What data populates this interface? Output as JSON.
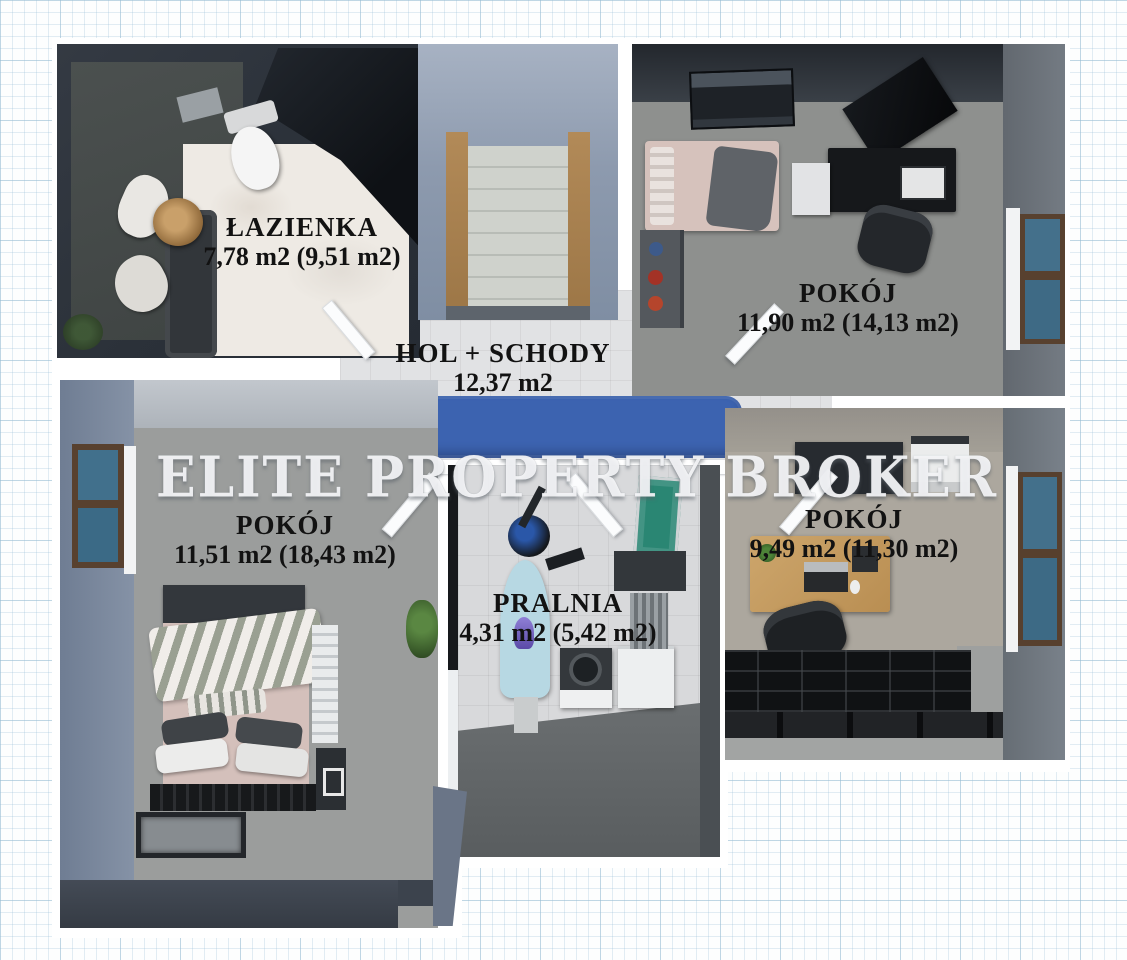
{
  "watermark": {
    "text": "ELITE PROPERTY BROKER"
  },
  "rooms": {
    "lazienka": {
      "name": "ŁAZIENKA",
      "area": "7,78 m2  (9,51 m2)"
    },
    "hol": {
      "name": "HOL + SCHODY",
      "area": "12,37 m2"
    },
    "pokoj_gorny": {
      "name": "POKÓJ",
      "area": "11,90 m2  (14,13 m2)"
    },
    "pokoj_lewy": {
      "name": "POKÓJ",
      "area": "11,51 m2  (18,43 m2)"
    },
    "pokoj_prawy": {
      "name": "POKÓJ",
      "area": "9,49 m2  (11,30 m2)"
    },
    "pralnia": {
      "name": "PRALNIA",
      "area": "4,31 m2  (5,42 m2)"
    }
  },
  "colors": {
    "rug_blue": "#3c63b0",
    "wall_dark": "#2e343c",
    "wall_bluegray": "#7f8da2",
    "stair_wood": "#b28a58",
    "marble": "#eeeae4",
    "window_glass": "#44708b",
    "window_frame": "#58412f",
    "desk_wood": "#c39a60",
    "drying_rack_green": "#2a8673",
    "label_text": "#121212"
  }
}
